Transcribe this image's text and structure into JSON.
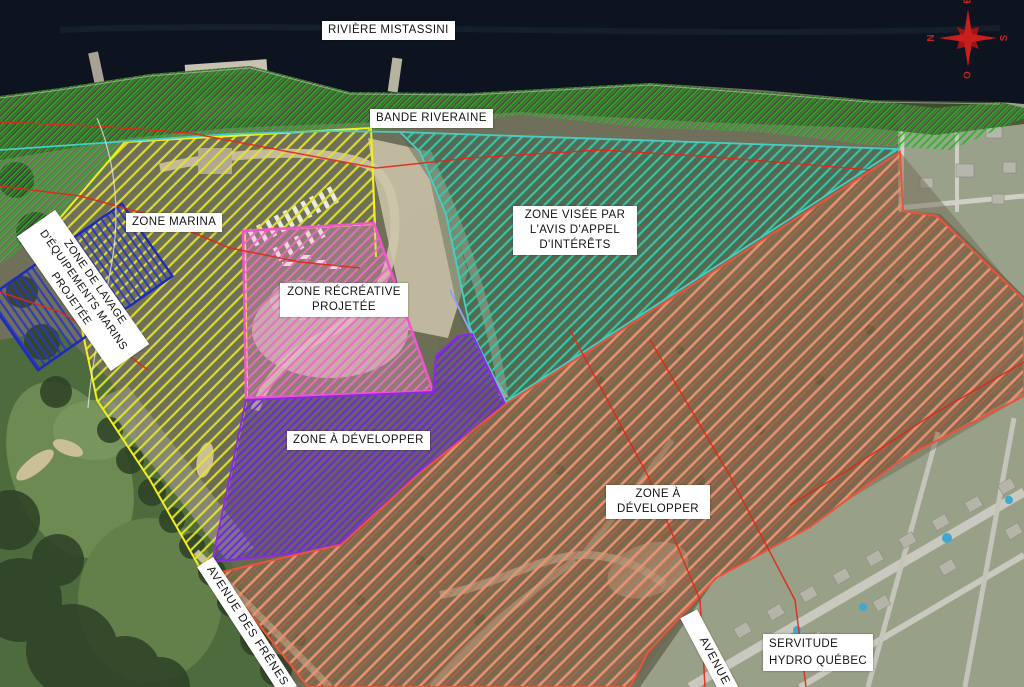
{
  "labels": {
    "river": "RIVIÈRE MISTASSINI",
    "riparian": "BANDE RIVERAINE",
    "marina": "ZONE MARINA",
    "wash": "ZONE DE LAVAGE\nD'ÉQUIPEMENTS MARINS\nPROJETÉE",
    "recreative": "ZONE  RÉCRÉATIVE\nPROJETÉE",
    "interest": "ZONE VISÉE PAR\nL'AVIS D'APPEL\nD'INTÉRÊTS",
    "develop_west": "ZONE À DÉVELOPPER",
    "develop_east": "ZONE À\nDÉVELOPPER",
    "avenue_frenes": "AVENUE DES FRÊNES",
    "avenue_partial": "AVENUE",
    "servitude": "SERVITUDE\nHYDRO QUÉBEC"
  },
  "compass": {
    "north": "N",
    "east": "E",
    "south": "S",
    "west": "O"
  },
  "zones": {
    "bande_riveraine": {
      "hatch": "#25b325",
      "hatch2": "#5ad95a"
    },
    "zone_marina": {
      "hatch": "#e4e42c",
      "outline": "#f2ee20"
    },
    "zone_lavage": {
      "hatch": "#2936c6",
      "outline": "#1f2cb8"
    },
    "zone_recreative": {
      "hatch": "#ee6ac6",
      "outline": "#f055cf"
    },
    "zone_a_developper_ouest": {
      "hatch": "#6c28d9",
      "outline": "#8a2be2"
    },
    "zone_avis_interets": {
      "hatch": "#33c9ab",
      "outline": "#45cfc4"
    },
    "zone_a_developper_est": {
      "hatch": "#ef9271",
      "hatch2": "#d85a3a",
      "outline": "#e8553a"
    },
    "servitude_hydro": {
      "line": "#e02818"
    },
    "compass_color": "#c81e1e"
  }
}
